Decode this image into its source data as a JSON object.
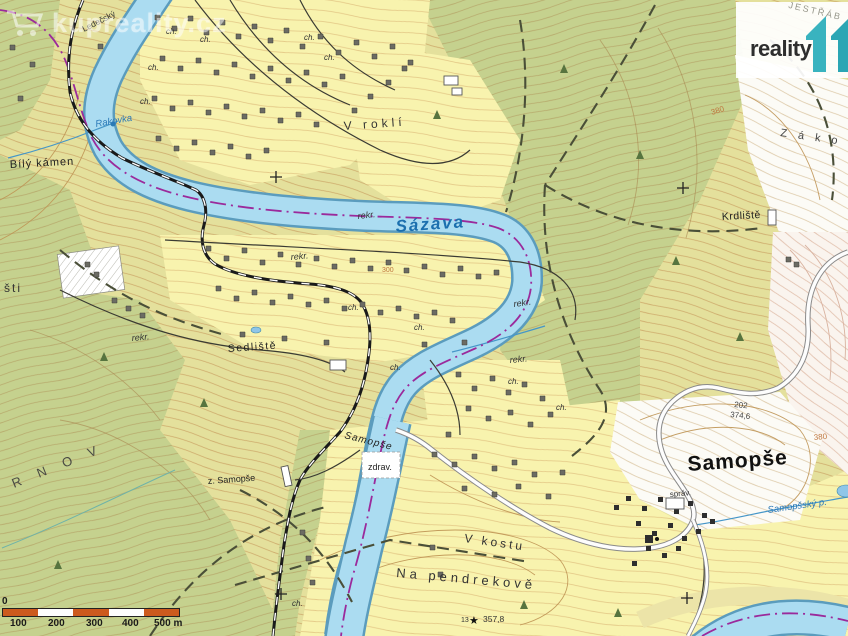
{
  "branding": {
    "logo_text": "reality",
    "watermark_text": "kupreality.cz"
  },
  "scale_bar": {
    "zero": "0",
    "labels": [
      "100",
      "200",
      "300",
      "400",
      "500 m"
    ]
  },
  "labels": {
    "river_main": "Sázava",
    "stream_nw": "Rakovka",
    "stream_se": "Samopšský p.",
    "village_main": "Samopše",
    "village_river_part": "Samopše",
    "hamlet_krdliste": "Krdliště",
    "hamlet_sedliste": "Sedliště",
    "place_bily_kamen": "Bílý kámen",
    "place_v_rokli": "V roklí",
    "place_v_kostu": "V kostu",
    "place_na_pendrekove": "Na pendrekově",
    "partial_sti": "šti",
    "partial_rnov": "R N O V",
    "partial_zako": "Z á k o",
    "partial_jestrab": "JESTŘÁB",
    "path_ledecsky": "Ledečský",
    "station_stop": "z. Samopše",
    "zdrav": "zdrav.",
    "sprav": "správ.",
    "road_point_id": "202",
    "elev_374_6": "374,6",
    "elev_380": "380",
    "elev_300": "300",
    "trig_id": "13",
    "trig_star": "★",
    "trig_elev": "357,8",
    "rekr": "rekr.",
    "ch": "ch."
  },
  "colors": {
    "water": "#abdcf1",
    "water_edge": "#5b9cbd",
    "forest": "#c5d18e",
    "field_yellow": "#f8f3ae",
    "open_olive": "#e4e09c",
    "contour_brown": "#c79b5e",
    "boundary_purple": "#9b2a9b",
    "railway_black": "#1a1a1a",
    "scale_orange": "#cc5a1e",
    "logo_teal": "#39b3bf",
    "label_water_blue": "#1b6fae"
  }
}
